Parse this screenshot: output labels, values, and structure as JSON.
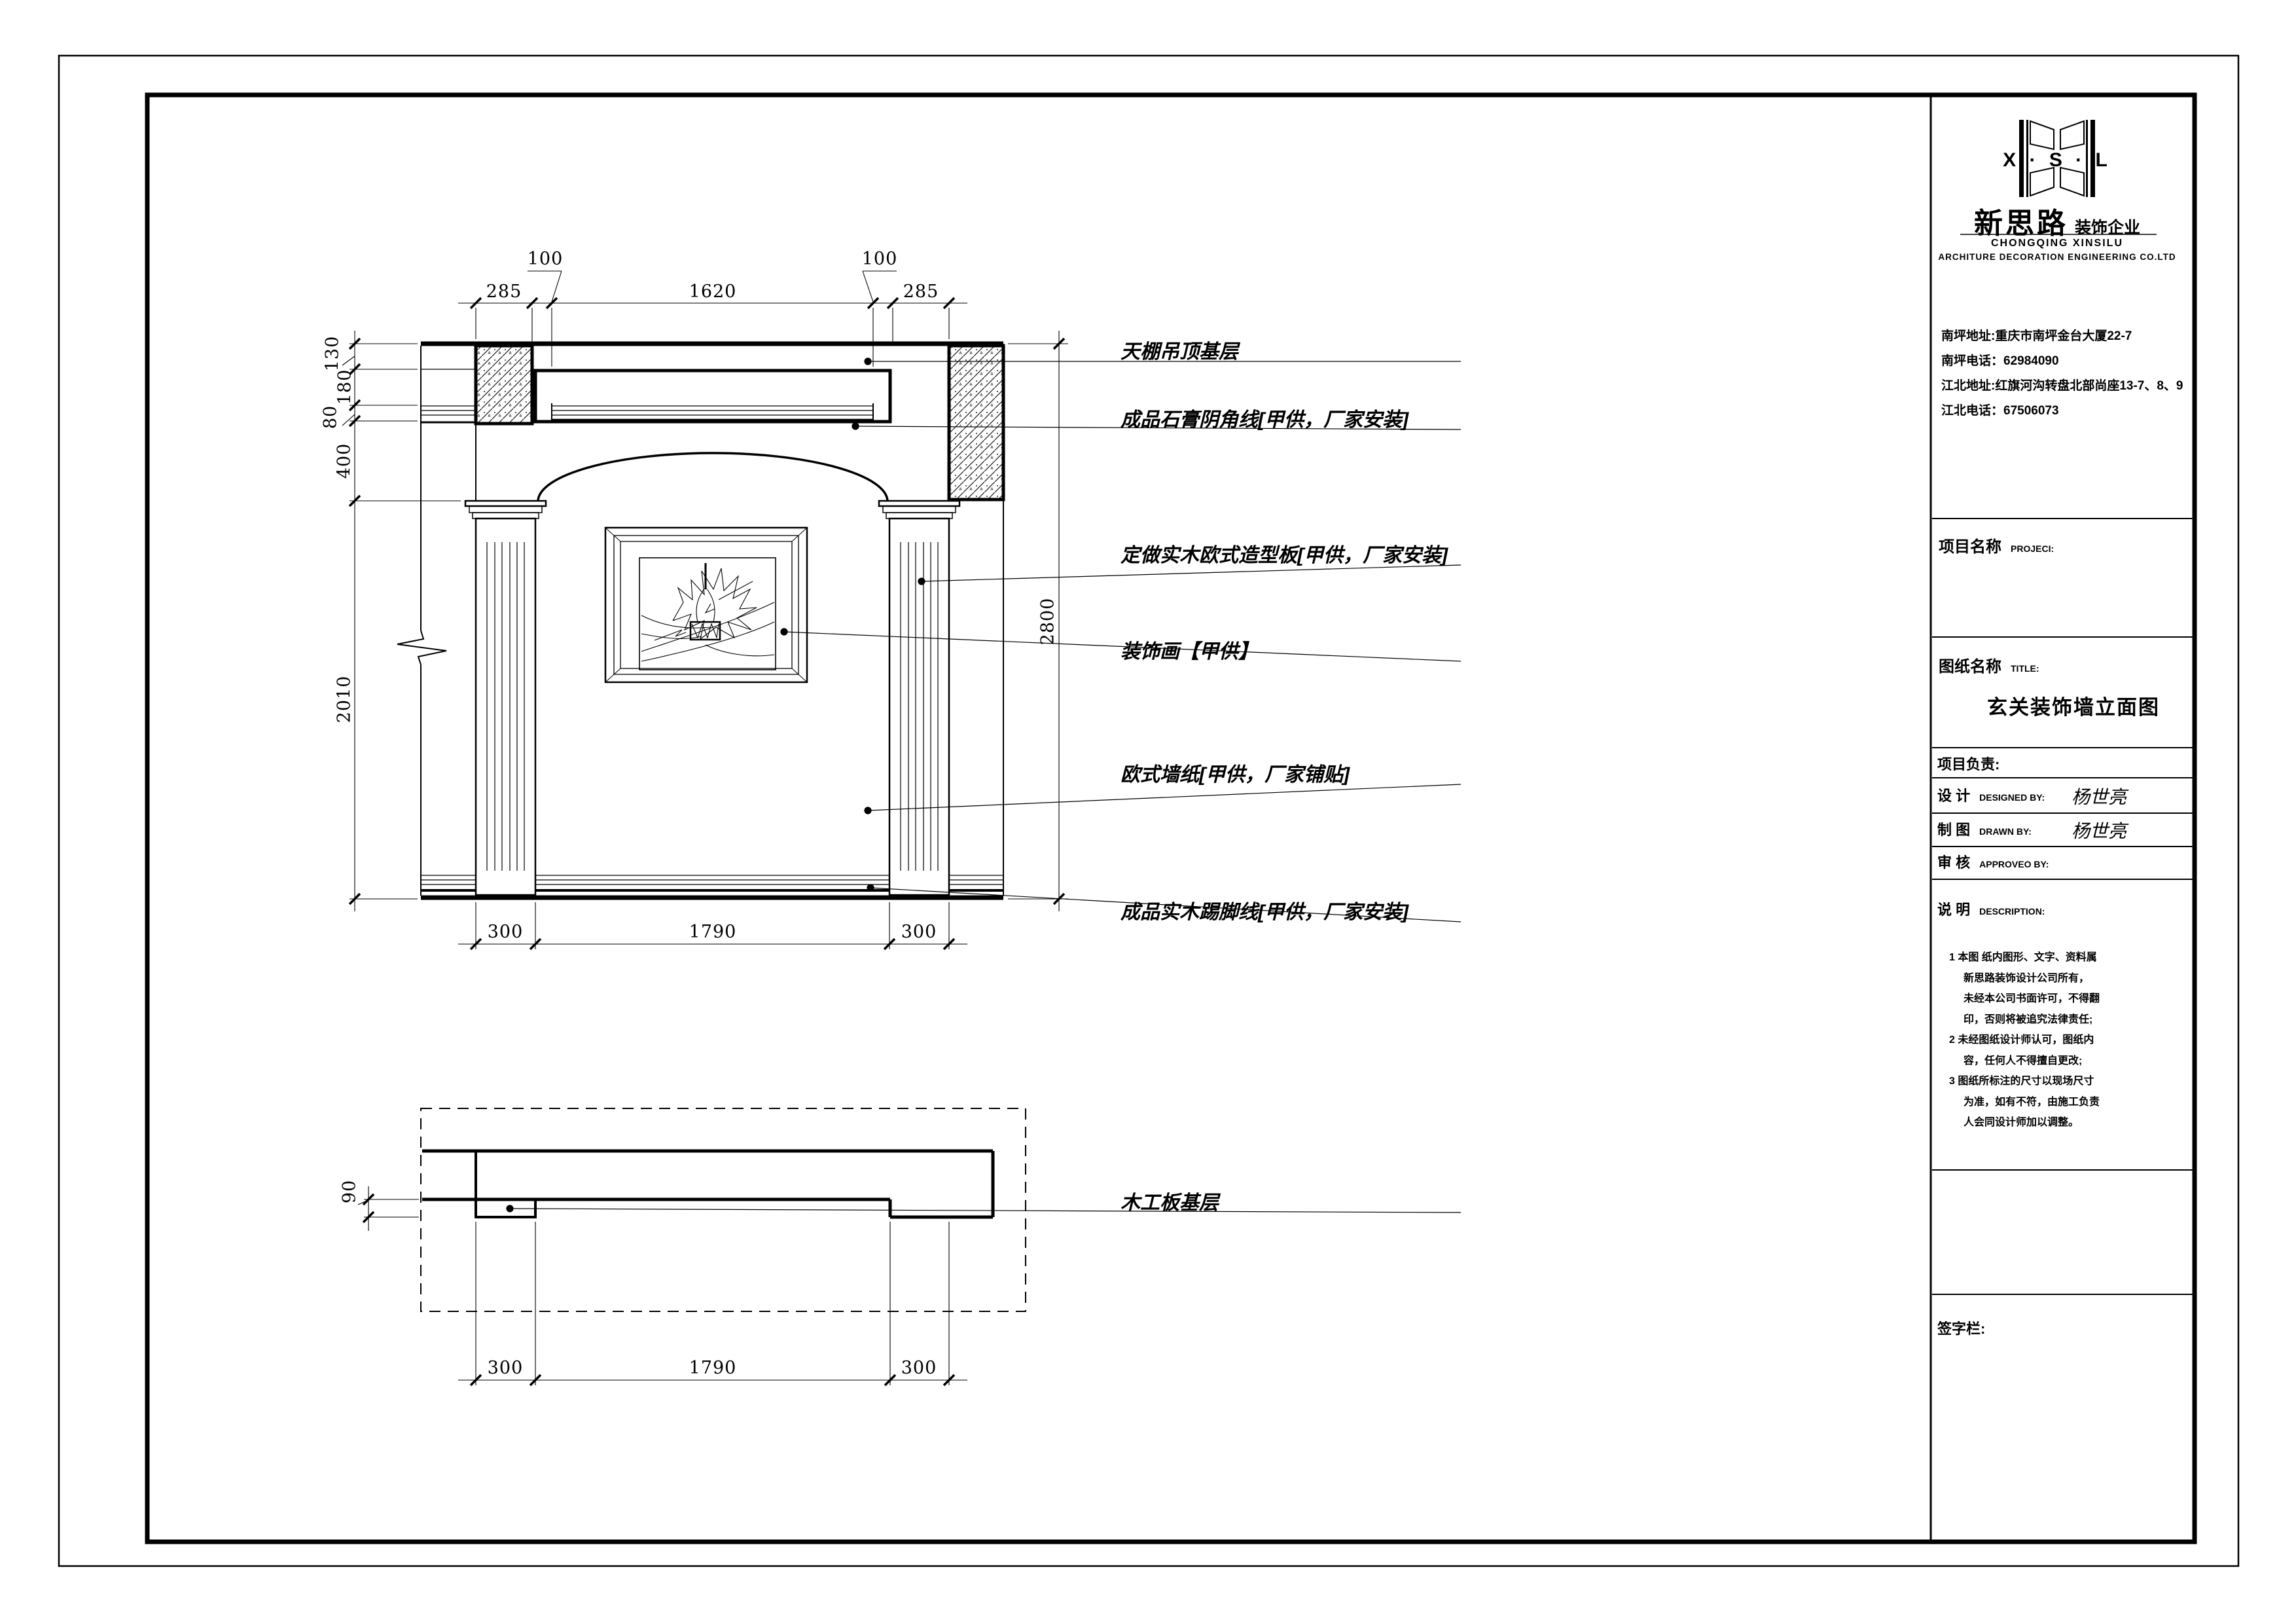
{
  "logo": {
    "xsl": "X · S · L",
    "name_cn": "新思路",
    "name_suffix": "装饰企业",
    "city_en": "CHONGQING XINSILU",
    "company_en": "ARCHITURE DECORATION ENGINEERING CO.LTD"
  },
  "contact": {
    "line1": "南坪地址:重庆市南坪金台大厦22-7",
    "line2": "南坪电话：62984090",
    "line3": "江北地址:红旗河沟转盘北部尚座13-7、8、9",
    "line4": "江北电话：67506073"
  },
  "fields": {
    "project_cn": "项目名称",
    "project_en": "PROJECI:",
    "sheet_cn": "图纸名称",
    "sheet_en": "TITLE:",
    "sheet_title": "玄关装饰墙立面图",
    "lead_label": "项目负责:",
    "design_cn": "设  计",
    "design_en": "DESIGNED BY:",
    "designer": "杨世亮",
    "draft_cn": "制  图",
    "draft_en": "DRAWN BY:",
    "drafter": "杨世亮",
    "check_cn": "审  核",
    "check_en": "APPROVEO BY:",
    "note_cn": "说  明",
    "note_en": "DESCRIPTION:",
    "signature": "签字栏:"
  },
  "notes": {
    "l1": "1 本图 纸内图形、文字、资料属",
    "l2": "新思路装饰设计公司所有，",
    "l3": "未经本公司书面许可，不得翻",
    "l4": "印，否则将被追究法律责任;",
    "l5": "2 未经图纸设计师认可，图纸内",
    "l6": "容，任何人不得擅自更改;",
    "l7": "3 图纸所标注的尺寸以现场尺寸",
    "l8": "为准，如有不符，由施工负责",
    "l9": "人会同设计师加以调整。"
  },
  "annotations": {
    "ceiling": "天棚吊顶基层",
    "cornice": "成品石膏阴角线[甲供，厂家安装]",
    "panel": "定做实木欧式造型板[甲供，厂家安装]",
    "painting": "装饰画【甲供】",
    "wallpaper": "欧式墙纸[甲供，厂家铺贴]",
    "skirting": "成品实木踢脚线[甲供，厂家安装]",
    "plan_board": "木工板基层"
  },
  "dims": {
    "top": [
      "285",
      "100",
      "1620",
      "100",
      "285"
    ],
    "left": [
      "130",
      "180",
      "80",
      "400",
      "2010"
    ],
    "right": [
      "2800"
    ],
    "bottom": [
      "300",
      "1790",
      "300"
    ],
    "plan_left": [
      "90"
    ],
    "plan_bottom": [
      "300",
      "1790",
      "300"
    ]
  }
}
